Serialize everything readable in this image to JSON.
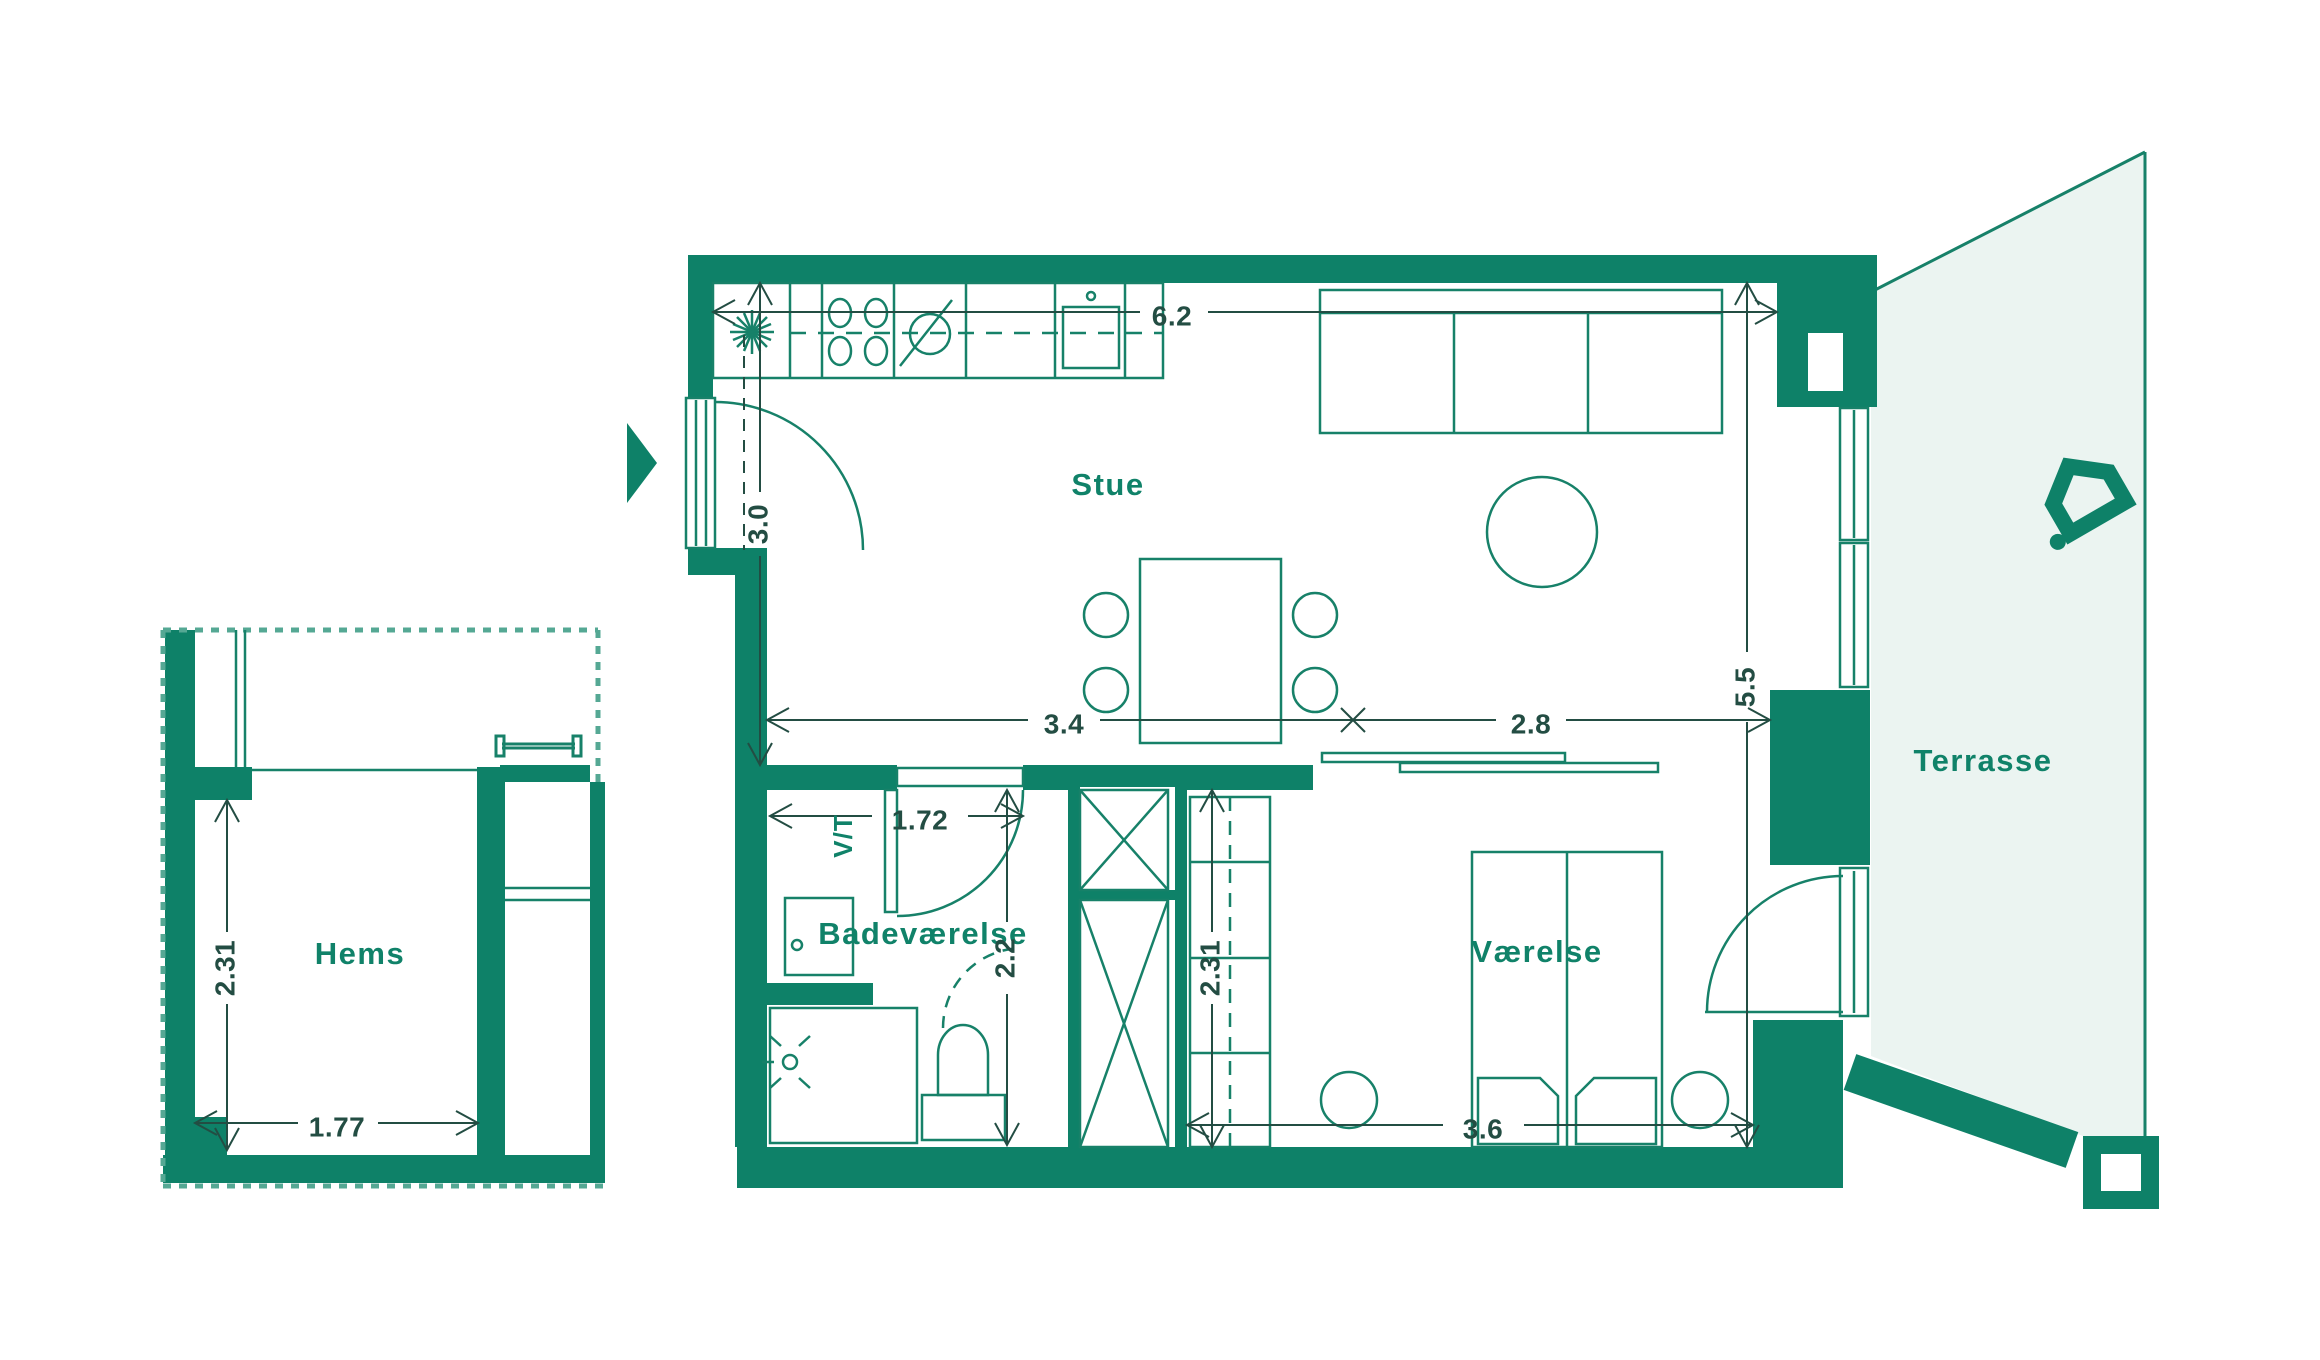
{
  "colors": {
    "wall": "#0E8168",
    "line": "#178169",
    "terrace_fill": "#EBF4F1",
    "dashed": "#55A894",
    "dim_text": "#234D43",
    "room_text": "#108269",
    "background": "#FFFFFF"
  },
  "rooms": {
    "stue": {
      "label": "Stue"
    },
    "badevaerelse": {
      "label": "Badeværelse"
    },
    "vaerelse": {
      "label": "Værelse"
    },
    "terrasse": {
      "label": "Terrasse"
    },
    "hems": {
      "label": "Hems"
    }
  },
  "appliances": {
    "washer_dryer": {
      "label": "V/T"
    }
  },
  "dimensions": {
    "stue_width": {
      "value": "6.2",
      "orientation": "horizontal"
    },
    "entry_depth": {
      "value": "3.0",
      "orientation": "vertical"
    },
    "stue_left": {
      "value": "3.4",
      "orientation": "horizontal"
    },
    "stue_right": {
      "value": "2.8",
      "orientation": "horizontal"
    },
    "unit_depth": {
      "value": "5.5",
      "orientation": "vertical"
    },
    "bath_width": {
      "value": "1.72",
      "orientation": "horizontal"
    },
    "bath_depth": {
      "value": "2.2",
      "orientation": "vertical"
    },
    "bedroom_depth": {
      "value": "2.31",
      "orientation": "vertical"
    },
    "bed_wall": {
      "value": "3.6",
      "orientation": "horizontal"
    },
    "hems_depth": {
      "value": "2.31",
      "orientation": "vertical"
    },
    "hems_width": {
      "value": "1.77",
      "orientation": "horizontal"
    }
  },
  "icons": {
    "entrance_arrow": "entrance-direction-marker",
    "house_logo": "brand-house-logo"
  }
}
